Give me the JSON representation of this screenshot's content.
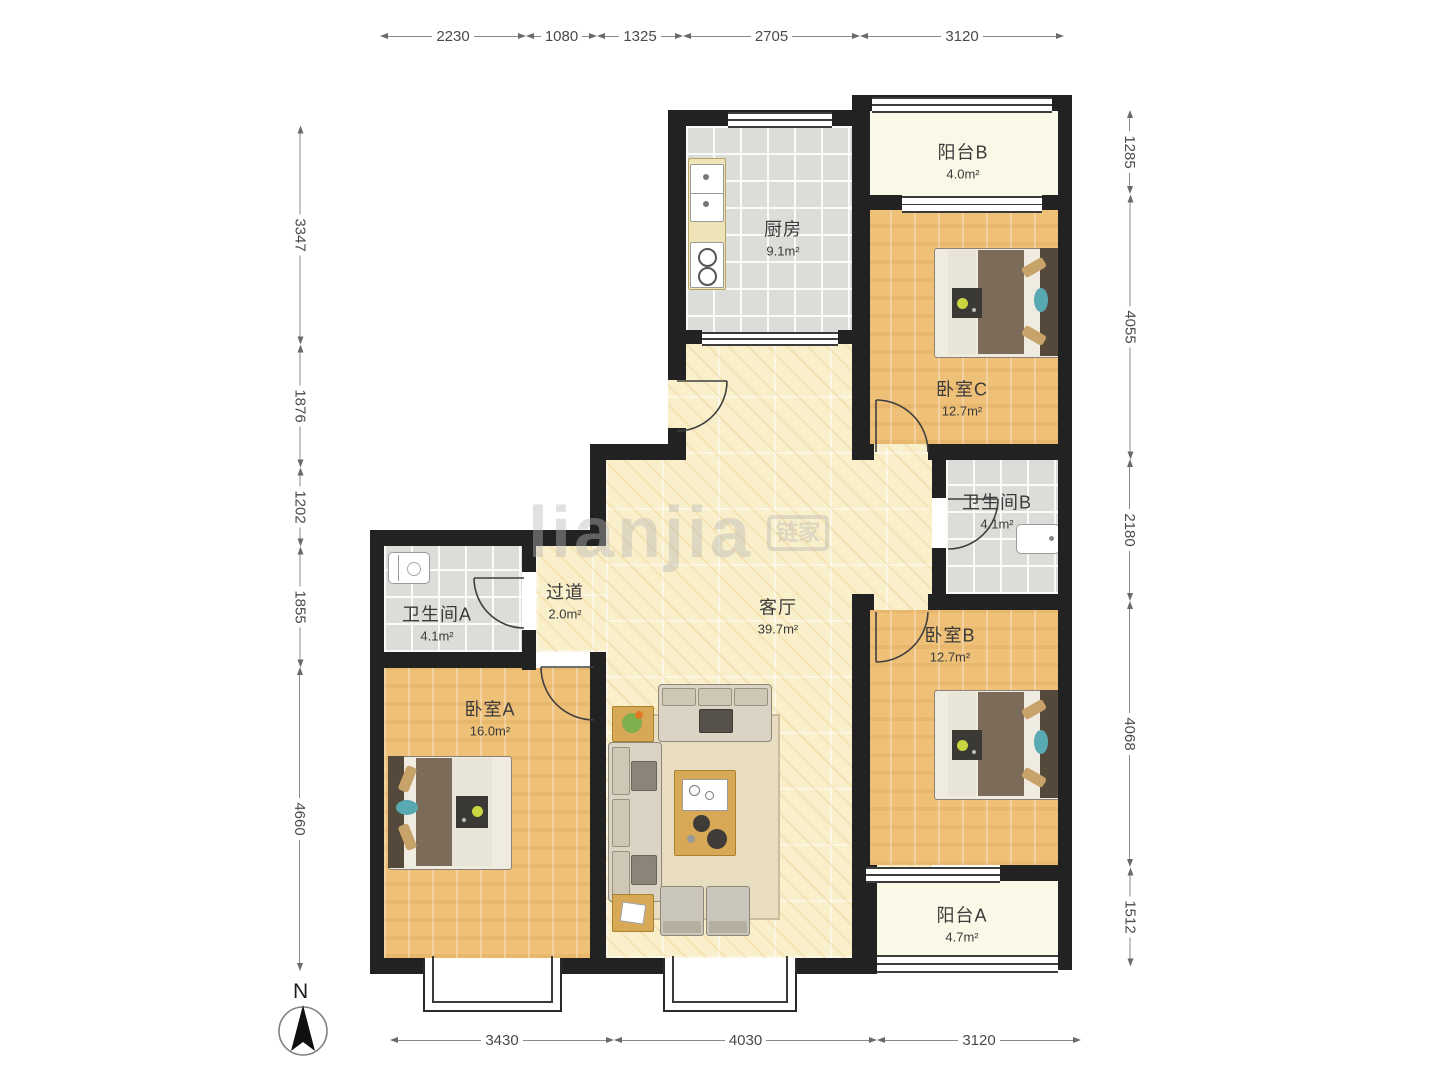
{
  "plan": {
    "title": "三室两卫户型图",
    "rooms": [
      {
        "id": "balcony-b",
        "name": "阳台B",
        "area": "4.0m²"
      },
      {
        "id": "kitchen",
        "name": "厨房",
        "area": "9.1m²"
      },
      {
        "id": "bedroom-c",
        "name": "卧室C",
        "area": "12.7m²"
      },
      {
        "id": "bathroom-b",
        "name": "卫生间B",
        "area": "4.1m²"
      },
      {
        "id": "bedroom-b",
        "name": "卧室B",
        "area": "12.7m²"
      },
      {
        "id": "balcony-a",
        "name": "阳台A",
        "area": "4.7m²"
      },
      {
        "id": "living",
        "name": "客厅",
        "area": "39.7m²"
      },
      {
        "id": "hallway",
        "name": "过道",
        "area": "2.0m²"
      },
      {
        "id": "bathroom-a",
        "name": "卫生间A",
        "area": "4.1m²"
      },
      {
        "id": "bedroom-a",
        "name": "卧室A",
        "area": "16.0m²"
      }
    ],
    "dimensions": {
      "top": [
        "2230",
        "1080",
        "1325",
        "2705",
        "3120"
      ],
      "bottom": [
        "3430",
        "4030",
        "3120"
      ],
      "left": [
        "3347",
        "1876",
        "1202",
        "1855",
        "4660"
      ],
      "right": [
        "1285",
        "4055",
        "2180",
        "4068",
        "1512"
      ]
    },
    "compass": {
      "label": "N"
    },
    "watermark": {
      "text": "lianjia",
      "logo": "链家"
    },
    "colors": {
      "wall": "#222222",
      "wood": "#eec078",
      "tile": "#dbddd9",
      "living": "#f9efca",
      "balcony": "#faf8e6"
    }
  }
}
